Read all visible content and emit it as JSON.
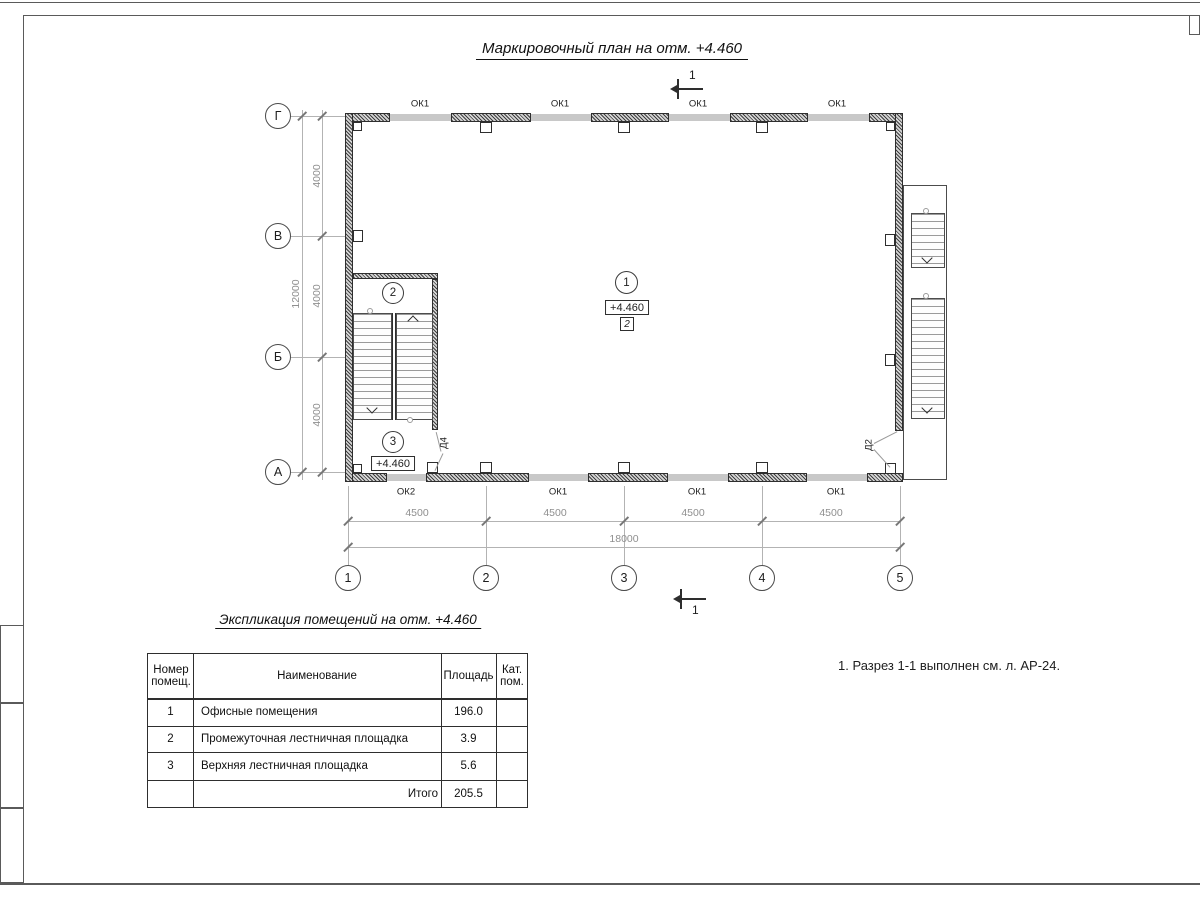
{
  "plan_title": "Маркировочный план на отм. +4.460",
  "axes": {
    "rows": [
      "Г",
      "В",
      "Б",
      "А"
    ],
    "cols": [
      "1",
      "2",
      "3",
      "4",
      "5"
    ]
  },
  "dims": {
    "left_segments": [
      "4000",
      "4000",
      "4000"
    ],
    "left_total": "12000",
    "bottom_segments": [
      "4500",
      "4500",
      "4500",
      "4500"
    ],
    "bottom_total": "18000"
  },
  "windows": {
    "top": [
      "ОК1",
      "ОК1",
      "ОК1",
      "ОК1"
    ],
    "bottom": [
      "ОК2",
      "ОК1",
      "ОК1",
      "ОК1"
    ]
  },
  "doors": {
    "d4": "Д4",
    "d2": "Д2"
  },
  "rooms": {
    "r1": {
      "num": "1",
      "elevation": "+4.460",
      "floor_type": "2"
    },
    "r2": {
      "num": "2"
    },
    "r3": {
      "num": "3",
      "elevation": "+4.460"
    }
  },
  "section": {
    "label": "1"
  },
  "schedule": {
    "title": "Экспликация помещений на отм. +4.460",
    "headers": {
      "num": "Номер помещ.",
      "name": "Наименование",
      "area": "Площадь",
      "cat": "Кат. пом."
    },
    "rows": [
      {
        "num": "1",
        "name": "Офисные помещения",
        "area": "196.0",
        "cat": ""
      },
      {
        "num": "2",
        "name": "Промежуточная лестничная площадка",
        "area": "3.9",
        "cat": ""
      },
      {
        "num": "3",
        "name": "Верхняя лестничная площадка",
        "area": "5.6",
        "cat": ""
      }
    ],
    "total_label": "Итого",
    "total_value": "205.5"
  },
  "notes": {
    "note1": "1. Разрез 1-1 выполнен см. л. АР-24."
  }
}
